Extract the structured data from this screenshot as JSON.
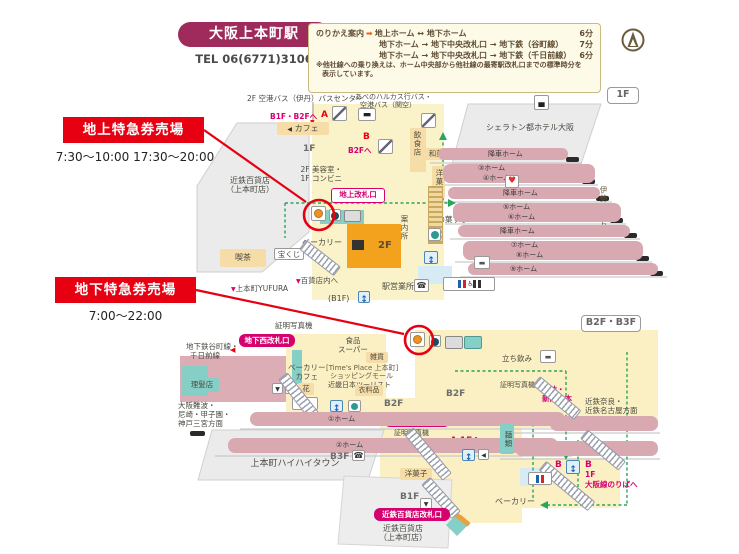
{
  "colors": {
    "brand": "#9e2b5c",
    "red": "#e60012",
    "magenta": "#d6006f",
    "pink": "#d9a9b2",
    "yellow": "#faf0c4",
    "orange": "#f2a21d",
    "tan": "#f6dca6",
    "teal": "#85cfc6",
    "green": "#2ba55a",
    "gray_building": "#ebebeb",
    "note_brown": "#5f4c33",
    "infobox_bg": "#fdfae8",
    "infobox_border": "#c9ba82"
  },
  "header": {
    "station_badge": "大阪上本町駅",
    "tel": "TEL 06(6771)3106",
    "floor_badge_top": "1F",
    "floor_badge_bottom": "B2F・B3F"
  },
  "transfer_box": {
    "title": "のりかえ案内",
    "arrow": "➡",
    "rows": [
      {
        "route": "地上ホーム ↔ 地下ホーム",
        "time": "6分"
      },
      {
        "route": "地下ホーム → 地下中央改札口 → 地下鉄（谷町線）",
        "time": "7分"
      },
      {
        "route": "地下ホーム → 地下中央改札口 → 地下鉄（千日前線）",
        "time": "6分"
      }
    ],
    "note1": "※他社線への乗り換えは、ホーム中央部から他社線の最寄駅改札口までの標準時分を",
    "note2": "表示しています。"
  },
  "annotations": {
    "ground_label": "地上特急券売場",
    "ground_hours": "7:30～10:00  17:30～20:00",
    "underground_label": "地下特急券売場",
    "underground_hours": "7:00～22:00"
  },
  "map1f": {
    "bus_center": "2F 空港バス（伊丹）バスセンター",
    "harukas1": "あべのハルカス行バス・",
    "harukas2": "空港バス（関空）",
    "to_b1b2": "B1F・B2Fへ",
    "exit_a": "A",
    "cafe": "カフェ",
    "floor": "1F",
    "exit_b": "B",
    "to_b2": "B2Fへ",
    "beauty1": "2F 美容室・",
    "beauty2": "1F コンビニ",
    "ground_gate": "地上改札口",
    "sheraton": "シェラトン都ホテル大阪",
    "restaurant": "飲食店",
    "wagashi": "和菓子",
    "yogashi": "洋菓子",
    "kakinoha": "柿の葉すし",
    "alight": "降車ホーム",
    "p3": "③ホーム",
    "p4": "④ホーム",
    "p5": "⑤ホーム",
    "p6": "⑥ホーム",
    "p7": "⑦ホーム",
    "p8": "⑧ホーム",
    "p9": "⑨ホーム",
    "ise": "伊勢志摩方面",
    "dept1": "近鉄百貨店",
    "dept2": "（上本町店）",
    "kissa": "喫茶",
    "bakery": "ベーカリー",
    "lottery": "宝くじ",
    "to_dept": "百貨店内へ",
    "yufura": "上本町YUFURA",
    "f2": "2F",
    "info_office": "案内所",
    "station_office": "駅営業所",
    "b1f": "(B1F)"
  },
  "mapb2": {
    "photo1": "証明写真機",
    "west_gate": "地下西改札口",
    "subway1": "地下鉄谷町線・",
    "subway2": "千日前線",
    "food1": "食品",
    "food2": "スーパー",
    "zakka": "雑貨",
    "bakery_cafe1": "ベーカリー",
    "bakery_cafe2": "カフェ",
    "times1": "[Time's Place 上本町]",
    "times2": "ショッピングモール",
    "tourist": "近畿日本ツーリスト",
    "barber": "理髪店",
    "flower": "花",
    "clothing": "衣料品",
    "b2f_left": "B2F",
    "b2f_right": "B2F",
    "central_gate": "地下中央改札口",
    "photo2": "証明写真機",
    "exit_a": "A",
    "to_1f": "1Fへ",
    "namba1": "大阪難波・",
    "namba2": "尼崎・甲子園・",
    "namba3": "神戸三宮方面",
    "haihai": "上本町ハイハイタウン",
    "p1": "①ホーム",
    "p2": "②ホーム",
    "b3f": "B3F",
    "b1f": "B1F",
    "yogashi": "洋菓子",
    "dept_gate": "近鉄百貨店改札口",
    "dept1": "近鉄百貨店",
    "dept2": "（上本町店）",
    "tachinomi": "立ち飲み",
    "photo3": "証明写真機",
    "books1": "雑誌・",
    "books2": "新聞・本",
    "nara1": "近鉄奈良・",
    "nara2": "近鉄名古屋方面",
    "noodle": "麺類",
    "exit_b1": "B",
    "exit_b2": "B",
    "osaka_line1": "1F",
    "osaka_line2": "大阪線のりばへ",
    "bakery": "ベーカリー"
  }
}
